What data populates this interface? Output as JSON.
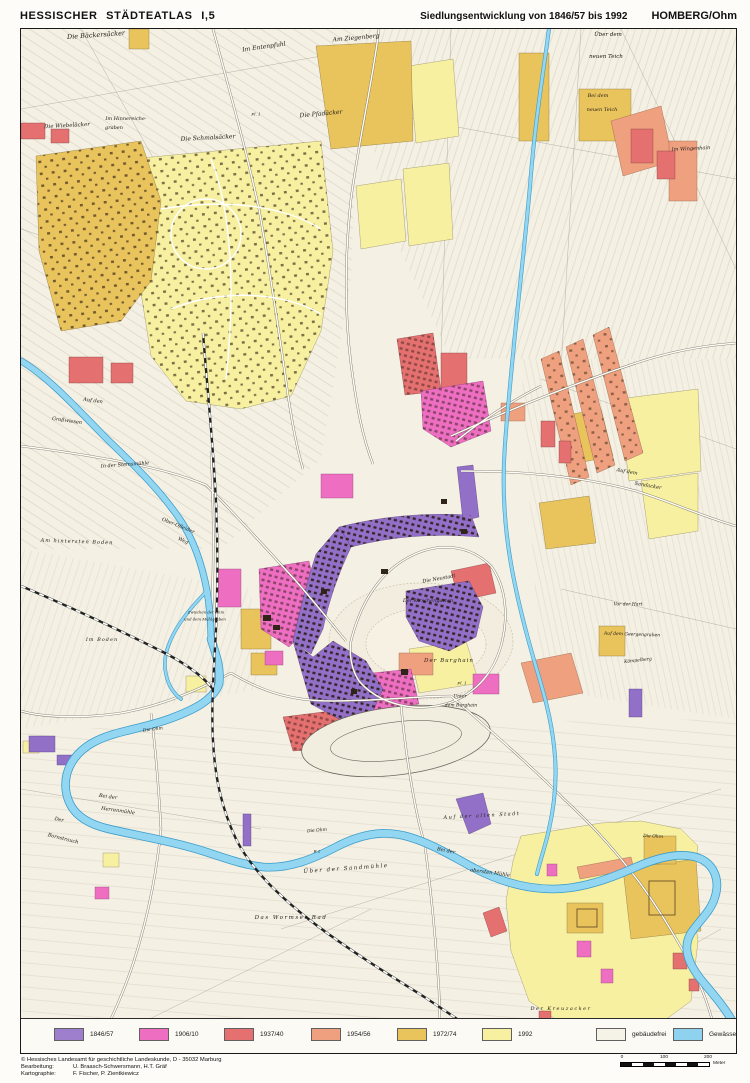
{
  "header": {
    "title": "HESSISCHER STÄDTEATLAS  I,5",
    "subtitle": "Siedlungsentwicklung von 1846/57 bis 1992",
    "city": "HOMBERG/Ohm"
  },
  "legend": {
    "items": [
      {
        "label": "1846/57",
        "color": "#9d7fce"
      },
      {
        "label": "1906/10",
        "color": "#ee6ec2"
      },
      {
        "label": "1937/40",
        "color": "#e57070"
      },
      {
        "label": "1954/56",
        "color": "#efa07f"
      },
      {
        "label": "1972/74",
        "color": "#e9c35c"
      },
      {
        "label": "1992",
        "color": "#f6f0a0"
      },
      {
        "label": "gebäudefrei",
        "color": "#f5f2e8"
      },
      {
        "label": "Gewässer",
        "color": "#8ed2ef"
      }
    ]
  },
  "map": {
    "water_color": "#93d6f2",
    "labels": [
      {
        "text": "Die Bäckersäcker",
        "x": 75,
        "y": 6,
        "size": 6.5,
        "rot": -4
      },
      {
        "text": "Im Entenpfuhl",
        "x": 243,
        "y": 18,
        "size": 6,
        "rot": -8
      },
      {
        "text": "Am Ziegenberg",
        "x": 335,
        "y": 9,
        "size": 6,
        "rot": -5
      },
      {
        "text": "Über dem",
        "x": 587,
        "y": 6,
        "size": 5.5,
        "rot": 0
      },
      {
        "text": "neuen Teich",
        "x": 585,
        "y": 28,
        "size": 5.5,
        "rot": 0
      },
      {
        "text": "Die Wiebeläcker",
        "x": 46,
        "y": 97,
        "size": 5.5,
        "rot": -3
      },
      {
        "text": "Im Hinnereiche-",
        "x": 105,
        "y": 90,
        "size": 5,
        "rot": 0
      },
      {
        "text": "graben",
        "x": 93,
        "y": 99,
        "size": 5,
        "rot": 0
      },
      {
        "text": "Die Schmalsäcker",
        "x": 187,
        "y": 109,
        "size": 6,
        "rot": -3
      },
      {
        "text": "Die Pfadäcker",
        "x": 300,
        "y": 85,
        "size": 6,
        "rot": -5
      },
      {
        "text": "Bei dem",
        "x": 577,
        "y": 67,
        "size": 5,
        "rot": 0
      },
      {
        "text": "neuen Teich",
        "x": 581,
        "y": 81,
        "size": 5,
        "rot": 0
      },
      {
        "text": "Im Wingenhain",
        "x": 670,
        "y": 120,
        "size": 5,
        "rot": -3
      },
      {
        "text": "Auf den",
        "x": 72,
        "y": 372,
        "size": 5,
        "rot": 8
      },
      {
        "text": "Großwiesen",
        "x": 46,
        "y": 392,
        "size": 5,
        "rot": 8
      },
      {
        "text": "In der Steinsmühle",
        "x": 104,
        "y": 436,
        "size": 5,
        "rot": -4
      },
      {
        "text": "Ober-Ofleider",
        "x": 157,
        "y": 497,
        "size": 5,
        "rot": 22
      },
      {
        "text": "Weg",
        "x": 162,
        "y": 512,
        "size": 5,
        "rot": 22
      },
      {
        "text": "Am hintersten Boden",
        "x": 56,
        "y": 513,
        "size": 5,
        "rot": 2,
        "ls": 1
      },
      {
        "text": "Im Boden",
        "x": 81,
        "y": 611,
        "size": 5,
        "rot": 0,
        "ls": 1
      },
      {
        "text": "Zwischen der Ohm",
        "x": 185,
        "y": 583,
        "size": 3.8,
        "rot": 0
      },
      {
        "text": "und dem Mühlgraben",
        "x": 184,
        "y": 590,
        "size": 3.8,
        "rot": 0
      },
      {
        "text": "Die Neustadt",
        "x": 418,
        "y": 550,
        "size": 5,
        "rot": -10
      },
      {
        "text": "Der Kirschengarten",
        "x": 407,
        "y": 572,
        "size": 5,
        "rot": 0
      },
      {
        "text": "Der Burghain",
        "x": 428,
        "y": 632,
        "size": 5.5,
        "rot": 0,
        "ls": 1
      },
      {
        "text": "Unter",
        "x": 439,
        "y": 668,
        "size": 4.5,
        "rot": 0
      },
      {
        "text": "dem Burghain",
        "x": 440,
        "y": 677,
        "size": 4.5,
        "rot": 0
      },
      {
        "text": "Auf dem",
        "x": 606,
        "y": 443,
        "size": 5,
        "rot": 10
      },
      {
        "text": "Sandacker",
        "x": 627,
        "y": 457,
        "size": 5,
        "rot": 10
      },
      {
        "text": "Vor der Hart",
        "x": 607,
        "y": 576,
        "size": 4.5,
        "rot": 0
      },
      {
        "text": "Auf dem Geergengraben",
        "x": 611,
        "y": 606,
        "size": 4.5,
        "rot": 2
      },
      {
        "text": "Kömpelberg",
        "x": 617,
        "y": 632,
        "size": 4.5,
        "rot": -6
      },
      {
        "text": "Bei der",
        "x": 87,
        "y": 768,
        "size": 5,
        "rot": 8
      },
      {
        "text": "Herrenmühle",
        "x": 97,
        "y": 782,
        "size": 5,
        "rot": 8
      },
      {
        "text": "Der",
        "x": 38,
        "y": 791,
        "size": 5,
        "rot": 14
      },
      {
        "text": "Bornstrauch",
        "x": 42,
        "y": 810,
        "size": 5,
        "rot": 14
      },
      {
        "text": "Die Ohm",
        "x": 132,
        "y": 701,
        "size": 4.5,
        "rot": -8
      },
      {
        "text": "Die Ohm",
        "x": 296,
        "y": 802,
        "size": 4.5,
        "rot": -5
      },
      {
        "text": "Die Ohm",
        "x": 632,
        "y": 808,
        "size": 4.5,
        "rot": 3
      },
      {
        "text": "Über der Sandmühle",
        "x": 325,
        "y": 840,
        "size": 5.5,
        "rot": -4,
        "ls": 1.5
      },
      {
        "text": "Auf der alten Stadt",
        "x": 461,
        "y": 787,
        "size": 5,
        "rot": -3,
        "ls": 1.5
      },
      {
        "text": "Bei der",
        "x": 425,
        "y": 822,
        "size": 5,
        "rot": 12
      },
      {
        "text": "obersten Mühle",
        "x": 469,
        "y": 844,
        "size": 5,
        "rot": 8
      },
      {
        "text": "Das Wormser Rad",
        "x": 270,
        "y": 889,
        "size": 5.5,
        "rot": 0,
        "ls": 1.5
      },
      {
        "text": "Der Kreuzacker",
        "x": 540,
        "y": 980,
        "size": 5,
        "rot": 0,
        "ls": 1.5
      },
      {
        "text": "R 2",
        "x": 296,
        "y": 822,
        "size": 4,
        "rot": 0
      },
      {
        "text": "Fl. 1",
        "x": 235,
        "y": 85,
        "size": 4,
        "rot": 0
      },
      {
        "text": "Fl. 1",
        "x": 441,
        "y": 654,
        "size": 4,
        "rot": 0
      }
    ]
  },
  "footer": {
    "copyright": "© Hessisches Landesamt für geschichtliche Landeskunde, D - 35032 Marburg",
    "editing_label": "Bearbeitung:",
    "editing": "U. Braasch-Schwersmann, H.T. Gräf",
    "cartography_label": "Kartographie:",
    "cartography": "F. Fischer, P. Zientkiewicz"
  },
  "scalebar": {
    "start": "0",
    "mid": "100",
    "end": "200",
    "unit": "Meter"
  }
}
